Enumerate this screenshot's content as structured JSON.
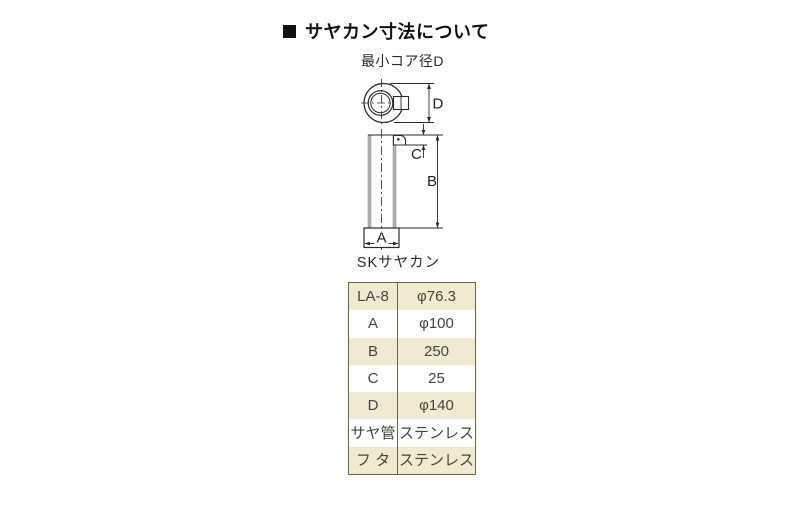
{
  "page": {
    "title_marker": "■",
    "title": "サヤカン寸法について"
  },
  "diagram": {
    "top_label": "最小コア径D",
    "bottom_label": "SKサヤカン",
    "dim_a": "A",
    "dim_b": "B",
    "dim_c": "C",
    "dim_d": "D"
  },
  "spec_table": {
    "rows": [
      {
        "label": "LA-8",
        "value": "φ76.3"
      },
      {
        "label": "A",
        "value": "φ100"
      },
      {
        "label": "B",
        "value": "250"
      },
      {
        "label": "C",
        "value": "25"
      },
      {
        "label": "D",
        "value": "φ140"
      },
      {
        "label": "サヤ管",
        "value": "ステンレス"
      },
      {
        "label": "フ タ",
        "value": "ステンレス"
      }
    ]
  },
  "colors": {
    "row_beige": "#f2e9d2",
    "table_border": "#6b6547",
    "line": "#2b2b2b",
    "wall_gray": "#b3b3b3"
  }
}
